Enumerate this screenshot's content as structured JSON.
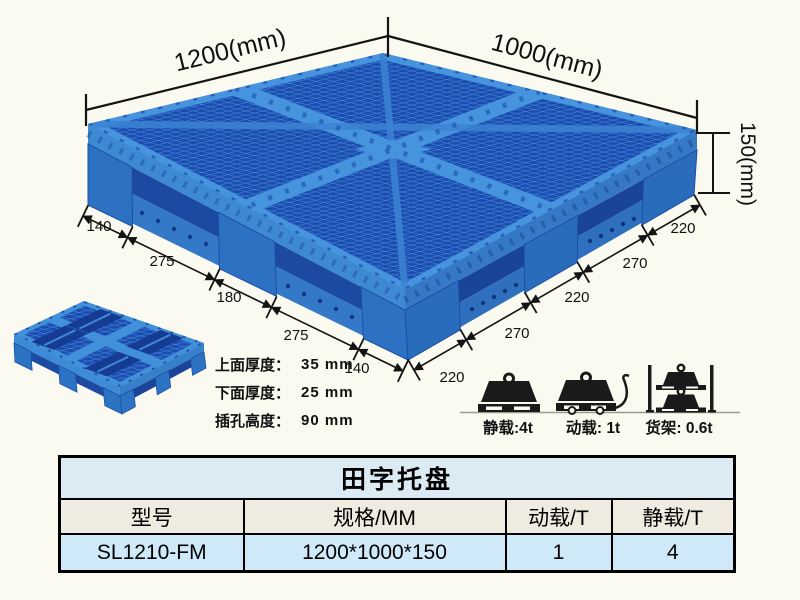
{
  "illustration": {
    "dim_length": "1200(mm)",
    "dim_width": "1000(mm)",
    "dim_height": "150(mm)",
    "left_chain": [
      "140",
      "275",
      "180",
      "275",
      "140"
    ],
    "right_chain": [
      "220",
      "270",
      "220",
      "270",
      "220"
    ],
    "notes": [
      {
        "label": "上面厚度：",
        "value": "35 mm"
      },
      {
        "label": "下面厚度：",
        "value": "25 mm"
      },
      {
        "label": "插孔高度：",
        "value": "90 mm"
      }
    ],
    "loads": {
      "static_label": "静载:4t",
      "dynamic_label": "动载: 1t",
      "rack_label": "货架: 0.6t"
    }
  },
  "table": {
    "title": "田字托盘",
    "headers": [
      "型号",
      "规格/MM",
      "动载/T",
      "静载/T"
    ],
    "row": [
      "SL1210-FM",
      "1200*1000*150",
      "1",
      "4"
    ]
  },
  "colors": {
    "pallet_light": "#4694de",
    "pallet_mid": "#2e74c4",
    "pallet_dark": "#1d4cb0",
    "background": "#fbfaf1",
    "table_title_bg": "#dbeaf3",
    "table_header_bg": "#efebe0",
    "table_row_bg": "#cfe9f8",
    "line_color": "#141414"
  }
}
